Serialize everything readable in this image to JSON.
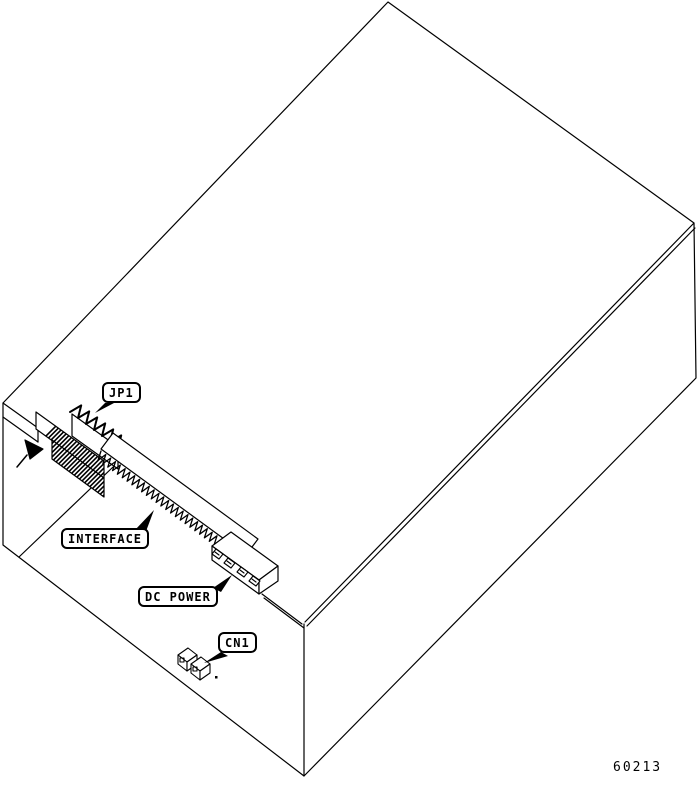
{
  "diagram": {
    "description": "Isometric line drawing of an equipment enclosure showing connector locations on the internal board edge",
    "labels": {
      "jp1": "JP1",
      "interface": "INTERFACE",
      "dc_power": "DC POWER",
      "cn1": "CN1"
    },
    "figure_number": "60213",
    "colors": {
      "line": "#000000",
      "background": "#ffffff"
    }
  }
}
